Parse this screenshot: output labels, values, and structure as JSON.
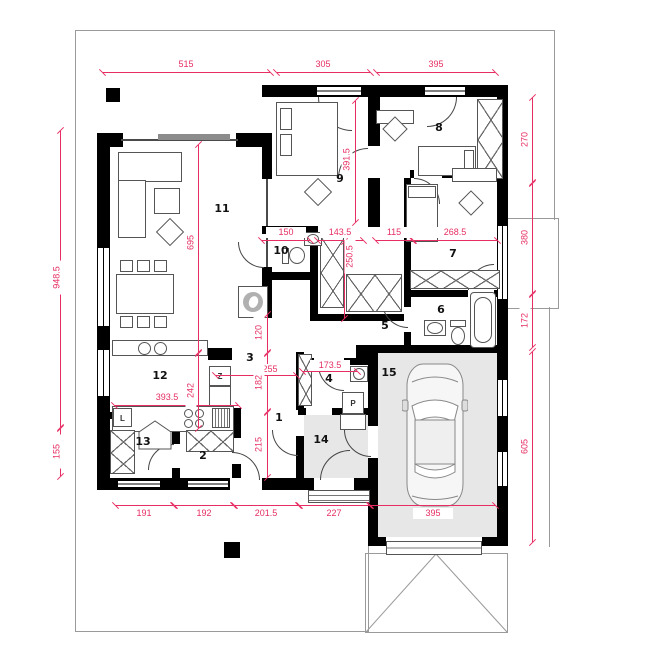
{
  "plan": {
    "type": "house-floor-plan",
    "rooms": [
      "1",
      "2",
      "3",
      "4",
      "5",
      "6",
      "7",
      "8",
      "9",
      "10",
      "11",
      "12",
      "13",
      "14",
      "15"
    ],
    "dims": {
      "top": [
        "515",
        "305",
        "395"
      ],
      "bottom": [
        "191",
        "192",
        "201.5",
        "227",
        "395"
      ],
      "left": [
        "948.5",
        "155"
      ],
      "right": [
        "270",
        "380",
        "172",
        "605"
      ],
      "interior": [
        "391.5",
        "695",
        "242",
        "120",
        "150",
        "143.5",
        "250.5",
        "115",
        "268.5",
        "255",
        "182",
        "215",
        "173.5",
        "393.5"
      ]
    },
    "appliances": {
      "fridge": "L",
      "dishwasher": "Z",
      "washer": "P"
    },
    "colors": {
      "dimension": "#e62e63",
      "wall": "#000000",
      "shaded_floor": "#e7e7e7"
    }
  }
}
